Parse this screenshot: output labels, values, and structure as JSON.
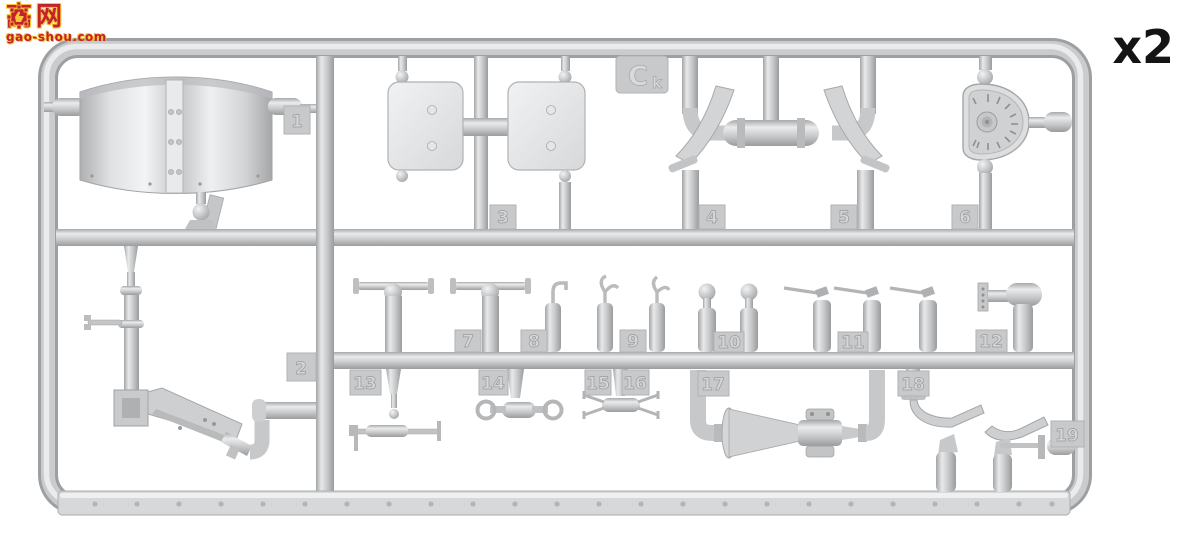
{
  "page": {
    "background": "#ffffff"
  },
  "watermark": {
    "char_1": "高",
    "char_2": "网",
    "domain": "gao-shou.com",
    "text_color": "#c4222a",
    "outline_color": "#f7c53a",
    "icon": "thumbs-up-gear-icon"
  },
  "quantity_label": "x2",
  "sprue": {
    "plastic_color": "#c9cbcd",
    "highlight_color": "#ecedef",
    "shadow_color": "#9da0a2",
    "tag_color": "#c7c9cb",
    "gate_label": {
      "letter": "C",
      "subscript": "k"
    },
    "part_tags": [
      {
        "label": "1"
      },
      {
        "label": "2"
      },
      {
        "label": "3"
      },
      {
        "label": "4"
      },
      {
        "label": "5"
      },
      {
        "label": "6"
      },
      {
        "label": "7"
      },
      {
        "label": "8"
      },
      {
        "label": "9"
      },
      {
        "label": "10"
      },
      {
        "label": "11"
      },
      {
        "label": "12"
      },
      {
        "label": "13"
      },
      {
        "label": "14"
      },
      {
        "label": "15"
      },
      {
        "label": "16"
      },
      {
        "label": "17"
      },
      {
        "label": "18"
      },
      {
        "label": "19"
      }
    ]
  }
}
